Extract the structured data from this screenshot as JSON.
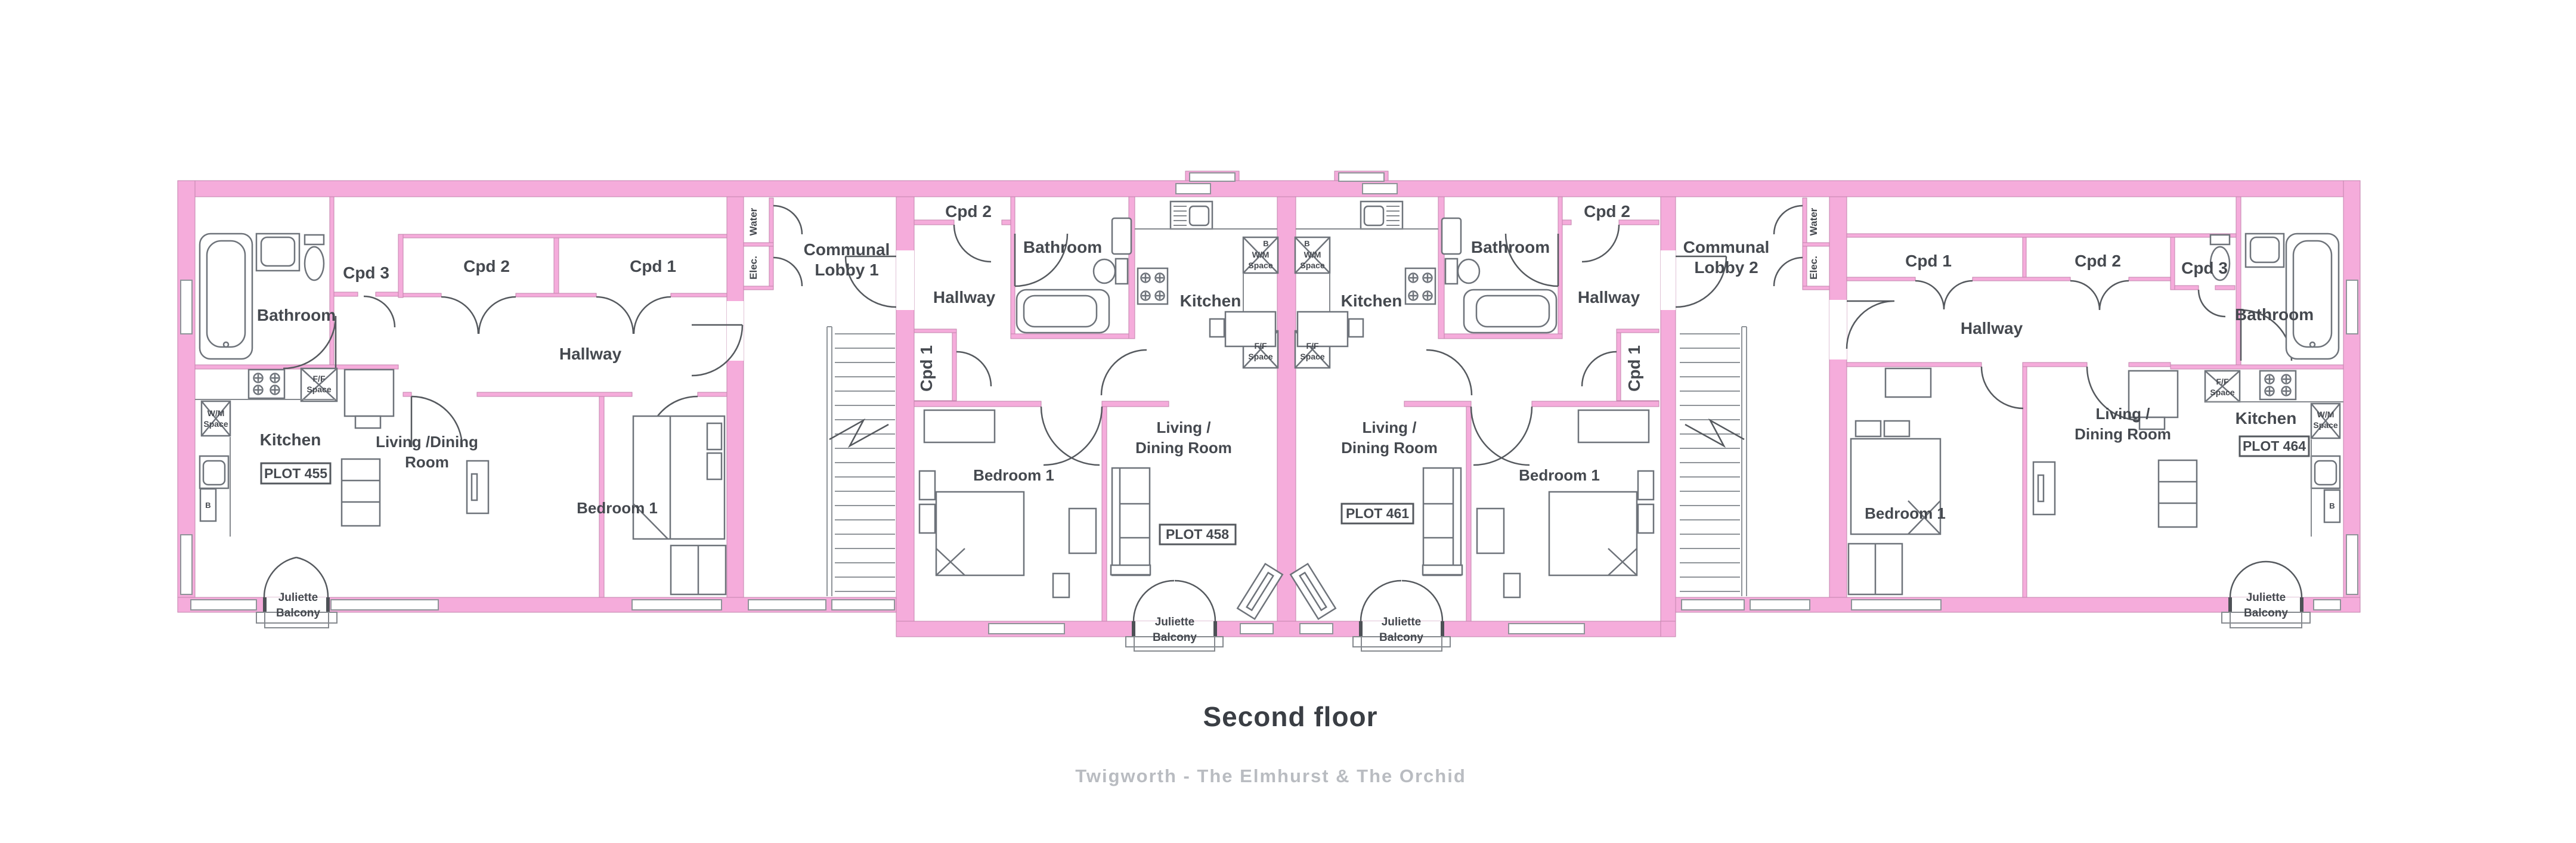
{
  "meta": {
    "title": "Second floor",
    "subtitle": "Twigworth - The Elmhurst & The Orchid"
  },
  "colors": {
    "wall": "#f5acdb",
    "line": "#6e737a",
    "text": "#45494f",
    "muted": "#b9bcc1"
  },
  "labels": {
    "bathroom": "Bathroom",
    "hallway": "Hallway",
    "kitchen": "Kitchen",
    "bedroom": "Bedroom 1",
    "living_split_1": "Living /",
    "living_split_2": "Dining Room",
    "living_combo_1": "Living /Dining",
    "living_combo_2": "Room",
    "cpd1": "Cpd 1",
    "cpd2": "Cpd 2",
    "cpd3": "Cpd 3",
    "communal": "Communal",
    "lobby1": "Lobby 1",
    "lobby2": "Lobby 2",
    "water": "Water",
    "elec": "Elec.",
    "juliette": "Juliette",
    "balcony": "Balcony",
    "wm": "W/M",
    "ff": "F/F",
    "space": "Space",
    "boiler": "B"
  },
  "plots": {
    "p455": "PLOT 455",
    "p458": "PLOT 458",
    "p461": "PLOT 461",
    "p464": "PLOT 464"
  }
}
